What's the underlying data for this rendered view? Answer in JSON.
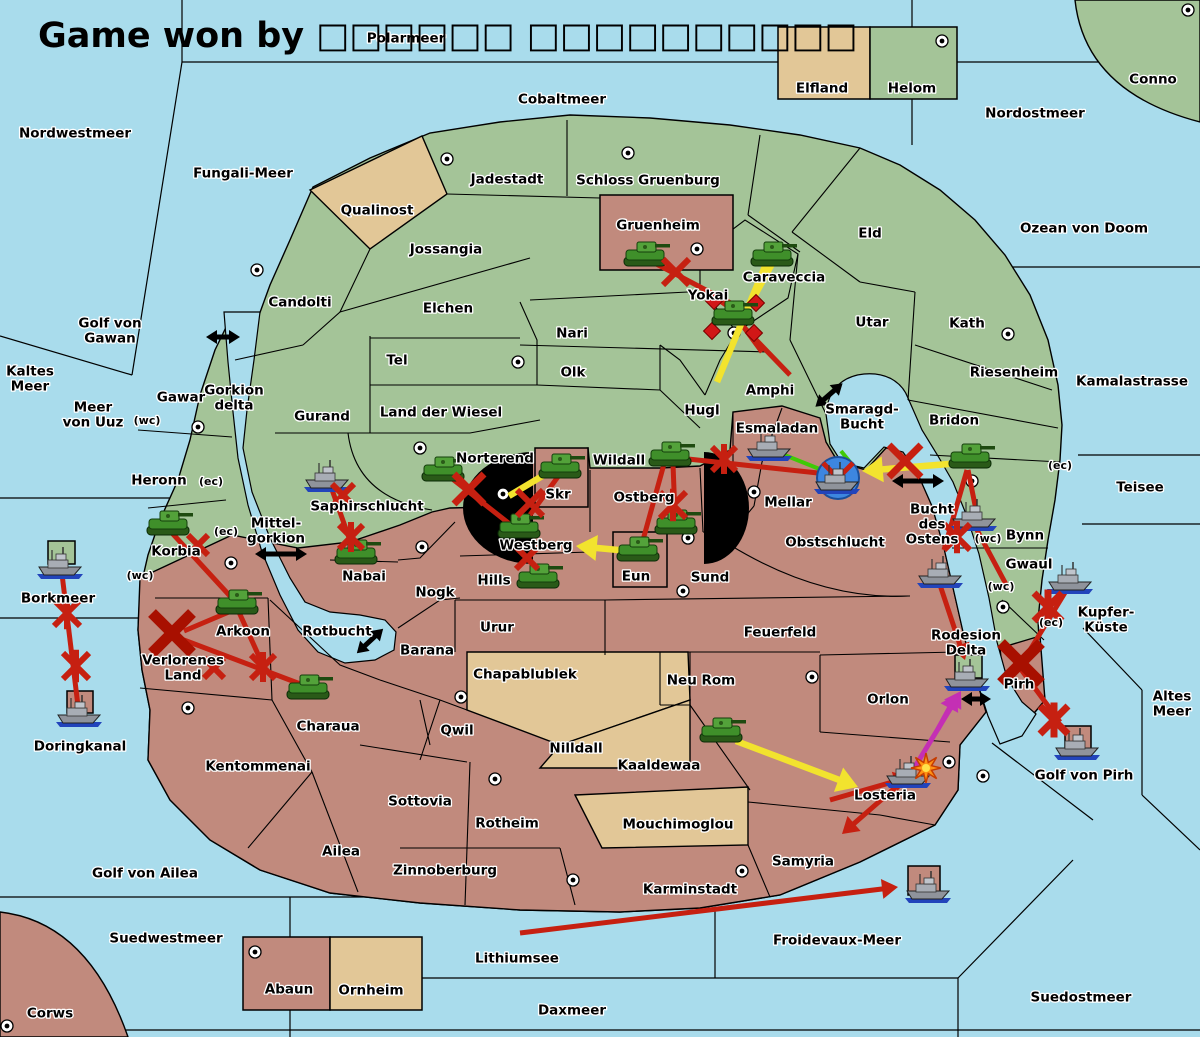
{
  "title": "Game won by □□□□□□ □□□□□□□□□□",
  "colors": {
    "sea": "#a9dcec",
    "land_green": "#a4c498",
    "land_red": "#c18a7d",
    "land_tan": "#e2c797",
    "attack_red": "#c62011",
    "big_x_red": "#a81000",
    "support_yellow": "#f2e32e",
    "support_green": "#3fca06",
    "convoy_magenta": "#c42fb4",
    "strait_black": "#000000",
    "dislodge_blue": "#3d86e0",
    "burst_orange": "#ff9214"
  },
  "labels": [
    {
      "t": "Polarmeer",
      "x": 406,
      "y": 38
    },
    {
      "t": "Nordwestmeer",
      "x": 75,
      "y": 133
    },
    {
      "t": "Cobaltmeer",
      "x": 562,
      "y": 99
    },
    {
      "t": "Nordostmeer",
      "x": 1035,
      "y": 113
    },
    {
      "t": "Conno",
      "x": 1153,
      "y": 79
    },
    {
      "t": "Elfland",
      "x": 822,
      "y": 88
    },
    {
      "t": "Helom",
      "x": 912,
      "y": 88
    },
    {
      "t": "Fungali-Meer",
      "x": 243,
      "y": 173
    },
    {
      "t": "Jadestadt",
      "x": 507,
      "y": 179
    },
    {
      "t": "Schloss Gruenburg",
      "x": 648,
      "y": 180
    },
    {
      "t": "Qualinost",
      "x": 377,
      "y": 210
    },
    {
      "t": "Gruenheim",
      "x": 658,
      "y": 225
    },
    {
      "t": "Eld",
      "x": 870,
      "y": 233
    },
    {
      "t": "Ozean von Doom",
      "x": 1084,
      "y": 228
    },
    {
      "t": "Jossangia",
      "x": 446,
      "y": 249
    },
    {
      "t": "Caraveccia",
      "x": 784,
      "y": 277
    },
    {
      "t": "Candolti",
      "x": 300,
      "y": 302
    },
    {
      "t": "Elchen",
      "x": 448,
      "y": 308
    },
    {
      "t": "Yokai",
      "x": 708,
      "y": 295
    },
    {
      "t": "Utar",
      "x": 872,
      "y": 322
    },
    {
      "t": "Kath",
      "x": 967,
      "y": 323
    },
    {
      "t": "Nari",
      "x": 572,
      "y": 333
    },
    {
      "ls": [
        "Golf von",
        "Gawan"
      ],
      "x": 110,
      "y": 323
    },
    {
      "t": "Tel",
      "x": 397,
      "y": 360
    },
    {
      "t": "Olk",
      "x": 573,
      "y": 372
    },
    {
      "ls": [
        "Kaltes",
        "Meer"
      ],
      "x": 30,
      "y": 371
    },
    {
      "t": "Riesenheim",
      "x": 1014,
      "y": 372
    },
    {
      "t": "Kamalastrasse",
      "x": 1132,
      "y": 381
    },
    {
      "t": "Gawar",
      "x": 181,
      "y": 397
    },
    {
      "ls": [
        "Gorkion",
        "delta"
      ],
      "x": 234,
      "y": 390
    },
    {
      "ls": [
        "Meer",
        "von Uuz"
      ],
      "x": 93,
      "y": 407
    },
    {
      "t": "Amphi",
      "x": 770,
      "y": 390
    },
    {
      "t": "Gurand",
      "x": 322,
      "y": 416
    },
    {
      "t": "Land der Wiesel",
      "x": 441,
      "y": 412
    },
    {
      "t": "Hugl",
      "x": 702,
      "y": 410
    },
    {
      "ls": [
        "Smaragd-",
        "Bucht"
      ],
      "x": 862,
      "y": 409
    },
    {
      "t": "Bridon",
      "x": 954,
      "y": 420
    },
    {
      "t": "(wc)",
      "x": 147,
      "y": 420,
      "s": 11
    },
    {
      "t": "Esmaladan",
      "x": 777,
      "y": 428
    },
    {
      "t": "Norterend",
      "x": 495,
      "y": 458
    },
    {
      "t": "Wildall",
      "x": 619,
      "y": 460
    },
    {
      "t": "Heronn",
      "x": 159,
      "y": 480
    },
    {
      "t": "(ec)",
      "x": 211,
      "y": 481,
      "s": 11
    },
    {
      "t": "(ec)",
      "x": 1060,
      "y": 465,
      "s": 11
    },
    {
      "t": "Teisee",
      "x": 1140,
      "y": 487
    },
    {
      "t": "Skr",
      "x": 558,
      "y": 494
    },
    {
      "t": "Ostberg",
      "x": 644,
      "y": 497
    },
    {
      "t": "Saphirschlucht",
      "x": 367,
      "y": 506
    },
    {
      "t": "Mellar",
      "x": 788,
      "y": 502
    },
    {
      "ls": [
        "Bucht",
        "des",
        "Ostens"
      ],
      "x": 932,
      "y": 509
    },
    {
      "ls": [
        "Mittel-",
        "gorkion"
      ],
      "x": 276,
      "y": 523
    },
    {
      "t": "(ec)",
      "x": 226,
      "y": 531,
      "s": 11
    },
    {
      "t": "Bynn",
      "x": 1025,
      "y": 535
    },
    {
      "t": "(wc)",
      "x": 988,
      "y": 538,
      "s": 11
    },
    {
      "t": "Obstschlucht",
      "x": 835,
      "y": 542
    },
    {
      "t": "Korbia",
      "x": 176,
      "y": 551
    },
    {
      "t": "Westberg",
      "x": 536,
      "y": 545
    },
    {
      "t": "Gwaul",
      "x": 1029,
      "y": 564
    },
    {
      "t": "Hills",
      "x": 494,
      "y": 580
    },
    {
      "t": "Nabai",
      "x": 364,
      "y": 576
    },
    {
      "t": "Eun",
      "x": 636,
      "y": 576
    },
    {
      "t": "Sund",
      "x": 710,
      "y": 577
    },
    {
      "t": "(wc)",
      "x": 140,
      "y": 575,
      "s": 11
    },
    {
      "t": "(wc)",
      "x": 1001,
      "y": 586,
      "s": 11
    },
    {
      "t": "Nogk",
      "x": 435,
      "y": 592
    },
    {
      "t": "Borkmeer",
      "x": 58,
      "y": 598
    },
    {
      "ls": [
        "Kupfer-",
        "Küste"
      ],
      "x": 1106,
      "y": 612
    },
    {
      "t": "(ec)",
      "x": 1051,
      "y": 622,
      "s": 11
    },
    {
      "t": "Urur",
      "x": 497,
      "y": 627
    },
    {
      "t": "Rotbucht",
      "x": 337,
      "y": 631
    },
    {
      "t": "Feuerfeld",
      "x": 780,
      "y": 632
    },
    {
      "t": "Arkoon",
      "x": 243,
      "y": 631
    },
    {
      "ls": [
        "Rodesion",
        "Delta"
      ],
      "x": 966,
      "y": 635
    },
    {
      "t": "Barana",
      "x": 427,
      "y": 650
    },
    {
      "ls": [
        "Verlorenes",
        "Land"
      ],
      "x": 183,
      "y": 660
    },
    {
      "t": "Chapablublek",
      "x": 525,
      "y": 674
    },
    {
      "t": "Neu Rom",
      "x": 701,
      "y": 680
    },
    {
      "t": "Pirh",
      "x": 1019,
      "y": 684
    },
    {
      "ls": [
        "Altes",
        "Meer"
      ],
      "x": 1172,
      "y": 696
    },
    {
      "t": "Orlon",
      "x": 888,
      "y": 699
    },
    {
      "t": "Charaua",
      "x": 328,
      "y": 726
    },
    {
      "t": "Qwil",
      "x": 457,
      "y": 730
    },
    {
      "t": "Nilldall",
      "x": 576,
      "y": 748
    },
    {
      "t": "Kaaldewaa",
      "x": 659,
      "y": 765
    },
    {
      "t": "Kentommenai",
      "x": 258,
      "y": 766
    },
    {
      "t": "Golf von Pirh",
      "x": 1084,
      "y": 775
    },
    {
      "t": "Doringkanal",
      "x": 80,
      "y": 746
    },
    {
      "t": "Losteria",
      "x": 885,
      "y": 795
    },
    {
      "t": "Sottovia",
      "x": 420,
      "y": 801
    },
    {
      "t": "Rotheim",
      "x": 507,
      "y": 823
    },
    {
      "t": "Mouchimoglou",
      "x": 678,
      "y": 824
    },
    {
      "t": "Ailea",
      "x": 341,
      "y": 851
    },
    {
      "t": "Samyria",
      "x": 803,
      "y": 861
    },
    {
      "t": "Zinnoberburg",
      "x": 445,
      "y": 870
    },
    {
      "t": "Golf von Ailea",
      "x": 145,
      "y": 873
    },
    {
      "t": "Karminstadt",
      "x": 690,
      "y": 889
    },
    {
      "t": "Suedwestmeer",
      "x": 166,
      "y": 938
    },
    {
      "t": "Froidevaux-Meer",
      "x": 837,
      "y": 940
    },
    {
      "t": "Lithiumsee",
      "x": 517,
      "y": 958
    },
    {
      "t": "Abaun",
      "x": 289,
      "y": 989
    },
    {
      "t": "Ornheim",
      "x": 371,
      "y": 990
    },
    {
      "t": "Daxmeer",
      "x": 572,
      "y": 1010
    },
    {
      "t": "Corws",
      "x": 50,
      "y": 1013
    },
    {
      "t": "Suedostmeer",
      "x": 1081,
      "y": 997
    }
  ],
  "units": {
    "armies": [
      {
        "region": "Gruenheim",
        "x": 645,
        "y": 255
      },
      {
        "region": "Caraveccia",
        "x": 772,
        "y": 255
      },
      {
        "region": "Yokai",
        "x": 733,
        "y": 314
      },
      {
        "region": "Norterend",
        "x": 443,
        "y": 470
      },
      {
        "region": "Skr",
        "x": 560,
        "y": 467
      },
      {
        "region": "Wildall",
        "x": 670,
        "y": 455
      },
      {
        "region": "Ostberg",
        "x": 676,
        "y": 523
      },
      {
        "region": "Westberg",
        "x": 519,
        "y": 527
      },
      {
        "region": "Hills",
        "x": 538,
        "y": 577
      },
      {
        "region": "Eun",
        "x": 638,
        "y": 550
      },
      {
        "region": "Korbia",
        "x": 168,
        "y": 524
      },
      {
        "region": "Nabai",
        "x": 356,
        "y": 553
      },
      {
        "region": "Arkoon",
        "x": 237,
        "y": 603
      },
      {
        "region": "Charaua",
        "x": 308,
        "y": 688
      },
      {
        "region": "Kaaldewaa",
        "x": 721,
        "y": 731
      },
      {
        "region": "Bridon",
        "x": 970,
        "y": 457
      }
    ],
    "fleets": [
      {
        "region": "Saphirschlucht",
        "x": 328,
        "y": 477
      },
      {
        "region": "Esmaladan",
        "x": 770,
        "y": 446
      },
      {
        "region": "Mellar",
        "x": 838,
        "y": 479
      },
      {
        "region": "Bucht des Ostens",
        "x": 975,
        "y": 516
      },
      {
        "region": "Bucht des Ostens",
        "x": 941,
        "y": 573
      },
      {
        "region": "Gwaul",
        "x": 1071,
        "y": 579
      },
      {
        "region": "Rodesion Delta",
        "x": 968,
        "y": 676
      },
      {
        "region": "Losteria",
        "x": 909,
        "y": 773
      },
      {
        "region": "Golf von Pirh",
        "x": 1078,
        "y": 745
      },
      {
        "region": "Borkmeer",
        "x": 61,
        "y": 564
      },
      {
        "region": "Doringkanal",
        "x": 80,
        "y": 712
      },
      {
        "region": "Froidevaux-Meer",
        "x": 929,
        "y": 888
      }
    ]
  },
  "supply_centers": [
    [
      942,
      41
    ],
    [
      1188,
      10
    ],
    [
      447,
      159
    ],
    [
      628,
      153
    ],
    [
      697,
      249
    ],
    [
      734,
      333
    ],
    [
      257,
      270
    ],
    [
      198,
      427
    ],
    [
      518,
      362
    ],
    [
      420,
      448
    ],
    [
      503,
      494
    ],
    [
      422,
      547
    ],
    [
      754,
      492
    ],
    [
      688,
      538
    ],
    [
      683,
      591
    ],
    [
      972,
      481
    ],
    [
      231,
      563
    ],
    [
      188,
      708
    ],
    [
      461,
      697
    ],
    [
      495,
      779
    ],
    [
      812,
      677
    ],
    [
      949,
      762
    ],
    [
      983,
      776
    ],
    [
      1003,
      607
    ],
    [
      573,
      880
    ],
    [
      742,
      871
    ],
    [
      7,
      1026
    ],
    [
      255,
      952
    ],
    [
      1008,
      334
    ]
  ],
  "boxes": [
    {
      "n": "Elfland",
      "x": 778,
      "y": 27,
      "w": 92,
      "h": 72,
      "f": "tan"
    },
    {
      "n": "Helom",
      "x": 870,
      "y": 27,
      "w": 87,
      "h": 72,
      "f": "green"
    },
    {
      "n": "Gruenheim",
      "x": 600,
      "y": 195,
      "w": 133,
      "h": 75,
      "f": "red"
    },
    {
      "n": "Skr",
      "x": 535,
      "y": 448,
      "w": 53,
      "h": 59,
      "f": "red"
    },
    {
      "n": "Eun",
      "x": 613,
      "y": 532,
      "w": 54,
      "h": 55,
      "f": "red"
    },
    {
      "n": "Abaun",
      "x": 243,
      "y": 937,
      "w": 87,
      "h": 73,
      "f": "red"
    },
    {
      "n": "Ornheim",
      "x": 330,
      "y": 937,
      "w": 92,
      "h": 73,
      "f": "tan"
    },
    {
      "n": "Borkmeer",
      "x": 48,
      "y": 541,
      "w": 27,
      "h": 23,
      "f": "green"
    },
    {
      "n": "Doringkanal",
      "x": 67,
      "y": 691,
      "w": 26,
      "h": 22,
      "f": "red"
    },
    {
      "n": "Rodesion Delta",
      "x": 955,
      "y": 655,
      "w": 27,
      "h": 23,
      "f": "green"
    },
    {
      "n": "Golf von Pirh",
      "x": 1065,
      "y": 726,
      "w": 26,
      "h": 30,
      "f": "red"
    },
    {
      "n": "Froidevaux-Meer",
      "x": 908,
      "y": 866,
      "w": 32,
      "h": 29,
      "f": "red"
    }
  ],
  "strait_arrows": [
    {
      "x": 223,
      "y": 337,
      "a": 0,
      "len": 34
    },
    {
      "x": 281,
      "y": 554,
      "a": 0,
      "len": 52
    },
    {
      "x": 829,
      "y": 395,
      "a": -41,
      "len": 36
    },
    {
      "x": 918,
      "y": 481,
      "a": 0,
      "len": 52
    },
    {
      "x": 370,
      "y": 641,
      "a": -43,
      "len": 36
    },
    {
      "x": 976,
      "y": 699,
      "a": 0,
      "len": 30
    }
  ],
  "orders": {
    "attacks": [
      {
        "p": [
          647,
          259,
          740,
          308
        ],
        "c": "red"
      },
      {
        "p": [
          735,
          318,
          790,
          375
        ],
        "c": "red"
      },
      {
        "p": [
          737,
          318,
          762,
          352
        ],
        "c": "red"
      },
      {
        "p": [
          700,
          287,
          736,
          312
        ],
        "c": "red"
      },
      {
        "p": [
          450,
          477,
          516,
          529
        ],
        "c": "red"
      },
      {
        "p": [
          560,
          474,
          524,
          523
        ],
        "c": "red"
      },
      {
        "p": [
          673,
          464,
          675,
          516
        ],
        "c": "red"
      },
      {
        "p": [
          664,
          464,
          643,
          540
        ],
        "c": "red"
      },
      {
        "p": [
          688,
          459,
          818,
          473
        ],
        "c": "red"
      },
      {
        "p": [
          967,
          470,
          944,
          550
        ],
        "c": "red"
      },
      {
        "p": [
          968,
          470,
          976,
          510
        ],
        "c": "red"
      },
      {
        "p": [
          940,
          585,
          965,
          660
        ],
        "c": "red",
        "head": true
      },
      {
        "p": [
          976,
          528,
          1008,
          588
        ],
        "c": "red"
      },
      {
        "p": [
          1066,
          591,
          1030,
          650
        ],
        "c": "red"
      },
      {
        "p": [
          1020,
          668,
          1060,
          722
        ],
        "c": "red"
      },
      {
        "p": [
          172,
          533,
          230,
          596
        ],
        "c": "red"
      },
      {
        "p": [
          236,
          609,
          184,
          631
        ],
        "c": "red"
      },
      {
        "p": [
          238,
          610,
          262,
          663
        ],
        "c": "red"
      },
      {
        "p": [
          176,
          637,
          303,
          685
        ],
        "c": "red"
      },
      {
        "p": [
          330,
          484,
          352,
          546
        ],
        "c": "red"
      },
      {
        "p": [
          62,
          574,
          78,
          706
        ],
        "c": "red"
      },
      {
        "p": [
          904,
          780,
          842,
          834
        ],
        "c": "red",
        "head": true
      },
      {
        "p": [
          830,
          800,
          910,
          777
        ],
        "c": "red",
        "head": true
      },
      {
        "p": [
          520,
          933,
          898,
          887
        ],
        "c": "red",
        "head": true
      },
      {
        "p": [
          773,
          262,
          749,
          306
        ],
        "c": "yellow"
      },
      {
        "p": [
          766,
          264,
          717,
          382
        ],
        "c": "yellow"
      },
      {
        "p": [
          961,
          463,
          862,
          471
        ],
        "c": "yellow",
        "head": true
      },
      {
        "p": [
          629,
          551,
          576,
          546
        ],
        "c": "yellow",
        "head": true
      },
      {
        "p": [
          736,
          741,
          858,
          787
        ],
        "c": "yellow",
        "head": true
      },
      {
        "p": [
          549,
          472,
          509,
          496
        ],
        "c": "yellow"
      },
      {
        "p": [
          777,
          452,
          822,
          470
        ],
        "c": "green"
      },
      {
        "p": [
          841,
          451,
          854,
          467
        ],
        "c": "green"
      },
      {
        "p": [
          913,
          770,
          961,
          691
        ],
        "c": "magenta",
        "head": true
      },
      {
        "p": [
          938,
          729,
          957,
          694
        ],
        "c": "magenta",
        "head": true
      }
    ],
    "marks": [
      {
        "k": "circlex",
        "x": 838,
        "y": 478
      },
      {
        "k": "diamond",
        "x": 714,
        "y": 301
      },
      {
        "k": "diamond",
        "x": 756,
        "y": 303
      },
      {
        "k": "diamond",
        "x": 712,
        "y": 331
      },
      {
        "k": "diamond",
        "x": 754,
        "y": 333
      },
      {
        "k": "x",
        "x": 676,
        "y": 272,
        "s": 13
      },
      {
        "k": "x",
        "x": 469,
        "y": 489,
        "s": 15
      },
      {
        "k": "x",
        "x": 530,
        "y": 503,
        "s": 13
      },
      {
        "k": "x",
        "x": 527,
        "y": 558,
        "s": 11
      },
      {
        "k": "x",
        "x": 343,
        "y": 495,
        "s": 11
      },
      {
        "k": "x",
        "x": 198,
        "y": 545,
        "s": 10
      },
      {
        "k": "x",
        "x": 214,
        "y": 668,
        "s": 10
      },
      {
        "k": "x",
        "x": 905,
        "y": 461,
        "s": 16
      },
      {
        "k": "ast",
        "x": 673,
        "y": 505,
        "s": 13
      },
      {
        "k": "ast",
        "x": 351,
        "y": 537,
        "s": 12
      },
      {
        "k": "ast",
        "x": 263,
        "y": 667,
        "s": 12
      },
      {
        "k": "ast",
        "x": 67,
        "y": 613,
        "s": 13
      },
      {
        "k": "ast",
        "x": 76,
        "y": 666,
        "s": 13
      },
      {
        "k": "ast",
        "x": 724,
        "y": 459,
        "s": 12
      },
      {
        "k": "ast",
        "x": 957,
        "y": 537,
        "s": 13
      },
      {
        "k": "ast",
        "x": 1048,
        "y": 607,
        "s": 14
      },
      {
        "k": "ast",
        "x": 1054,
        "y": 720,
        "s": 14
      },
      {
        "k": "bigx",
        "x": 172,
        "y": 633,
        "s": 20
      },
      {
        "k": "bigx",
        "x": 1021,
        "y": 663,
        "s": 20
      },
      {
        "k": "burst",
        "x": 926,
        "y": 768
      }
    ]
  }
}
